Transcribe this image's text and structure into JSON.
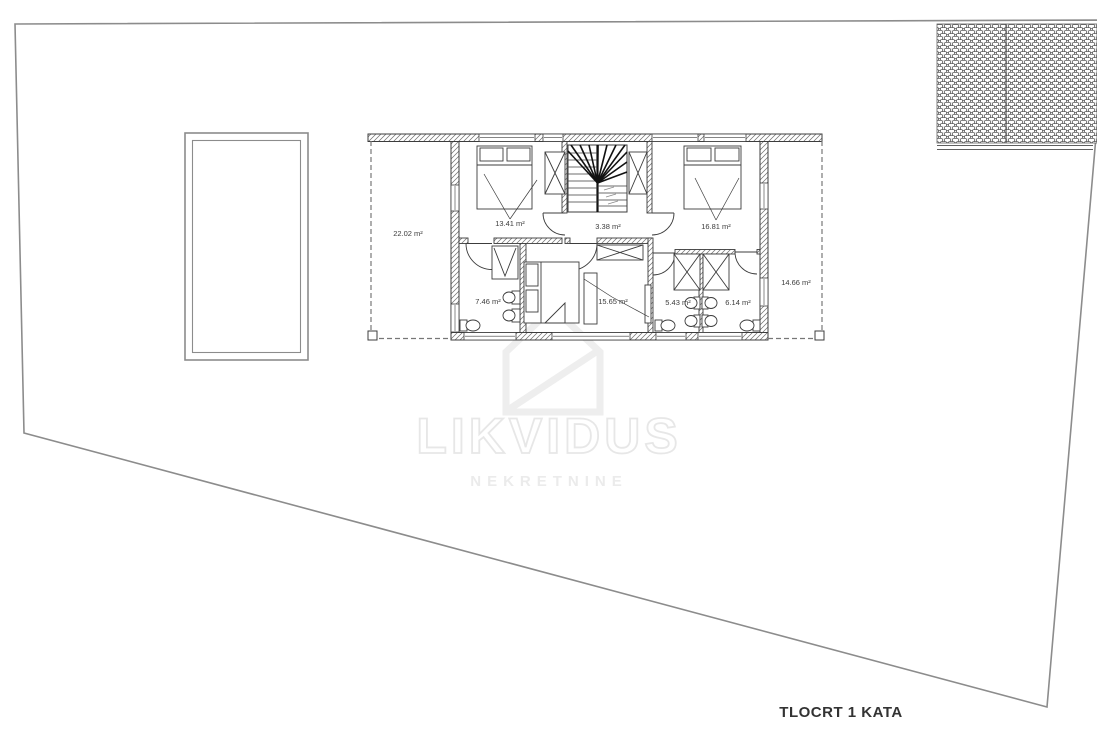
{
  "page": {
    "title": "TLOCRT 1 KATA"
  },
  "colors": {
    "background": "#ffffff",
    "plan_line": "#3c3c3c",
    "site_line": "#8c8c8c",
    "watermark": "#ebebeb"
  },
  "watermark": {
    "brand": "LIKVIDUS",
    "subtitle": "NEKRETNINE",
    "logo": "house-logo-icon"
  },
  "floorplan": {
    "rooms": [
      {
        "id": "terrace-left",
        "area": "22.02 m²"
      },
      {
        "id": "bedroom-top-left",
        "area": "13.41 m²"
      },
      {
        "id": "stair-hall",
        "area": "3.38 m²"
      },
      {
        "id": "bedroom-top-right",
        "area": "16.81 m²"
      },
      {
        "id": "bathroom-left",
        "area": "7.46 m²"
      },
      {
        "id": "bedroom-bottom",
        "area": "15.65 m²"
      },
      {
        "id": "bathroom-middle",
        "area": "5.43 m²"
      },
      {
        "id": "bathroom-right",
        "area": "6.14 m²"
      },
      {
        "id": "terrace-right",
        "area": "14.66 m²"
      }
    ]
  }
}
